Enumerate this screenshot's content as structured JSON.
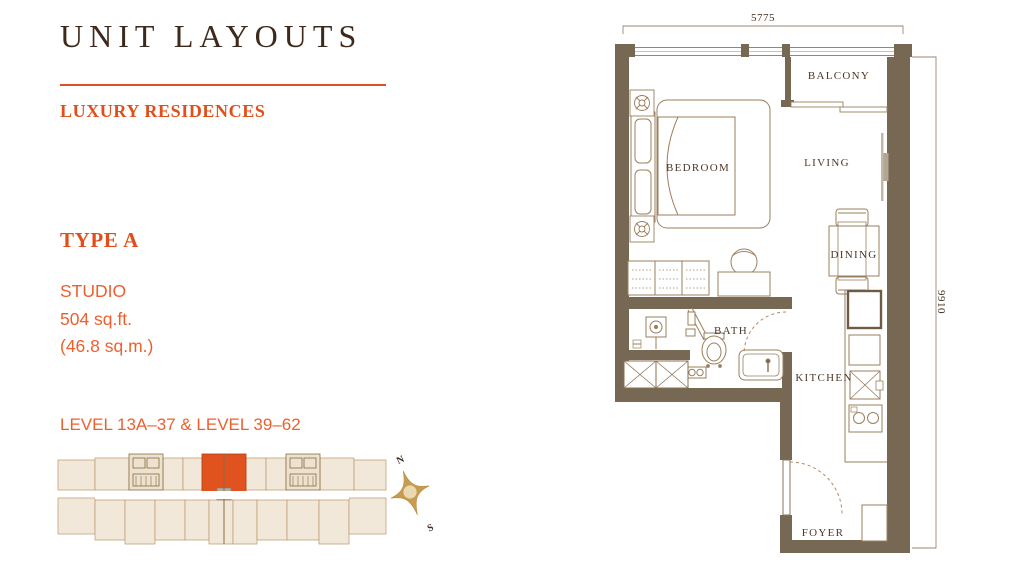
{
  "header": {
    "title": "UNIT LAYOUTS",
    "subtitle": "LUXURY RESIDENCES"
  },
  "unit": {
    "type_name": "TYPE A",
    "category": "STUDIO",
    "area_sqft": "504 sq.ft.",
    "area_sqm": "(46.8 sq.m.)",
    "levels": "LEVEL 13A–37 & LEVEL 39–62"
  },
  "floorplan": {
    "dim_width": "5775",
    "dim_height": "9910",
    "rooms": {
      "balcony": "BALCONY",
      "bedroom": "BEDROOM",
      "living": "LIVING",
      "dining": "DINING",
      "kitchen": "KITCHEN",
      "bath": "BATH",
      "foyer": "FOYER"
    }
  },
  "compass": {
    "north": "N",
    "south": "S"
  },
  "colors": {
    "accent_orange": "#E04F1B",
    "body_orange": "#EE5F2D",
    "highlight_unit_orange": "#E0521E",
    "title_brown": "#3E2A1D",
    "wall_brown": "#776853",
    "keyplan_beige": "#F1E8D9",
    "compass_gold": "#C89C4E"
  }
}
